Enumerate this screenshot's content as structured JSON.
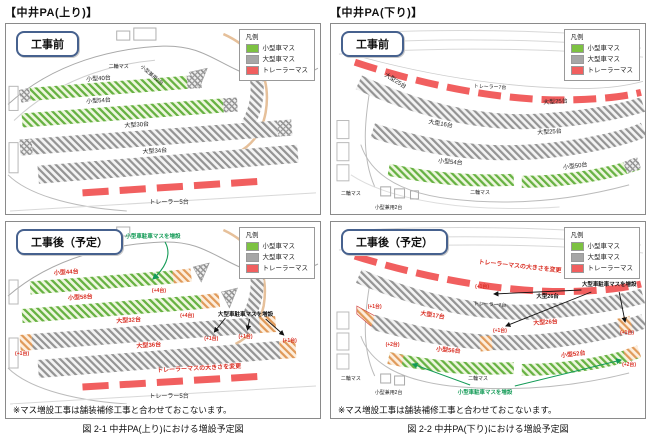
{
  "legend": {
    "title": "凡例",
    "small": "小型車マス",
    "large": "大型車マス",
    "trailer": "トレーラーマス"
  },
  "colors": {
    "small": "#7dc242",
    "large": "#a6a6a6",
    "trailer": "#f15f5f",
    "added_label": "#d93025",
    "annotation_green": "#149b57",
    "stage_frame": "#46618e"
  },
  "left": {
    "title": "【中井PA(上り)】",
    "caption": "図 2-1 中井PA(上り)における増設予定図",
    "note": "※マス増設工事は舗装補修工事と合わせておこないます。",
    "before": {
      "stage": "工事前",
      "labels": {
        "moto": "二輪マス",
        "combo": "小型兼用2台",
        "small1": "小型40台",
        "small2": "小型54台",
        "large1": "大型30台",
        "large2": "大型34台",
        "trailer": "トレーラー5台"
      }
    },
    "after": {
      "stage": "工事後（予定）",
      "labels": {
        "annot_small": "小型車駐車マスを増設",
        "annot_large": "大型車駐車マスを増設",
        "small1": "小型44台",
        "small1_add": "(+4台)",
        "small2": "小型58台",
        "small2_add": "(+4台)",
        "large1": "大型32台",
        "large2": "大型36台",
        "add1": "(+1台)",
        "add2": "(+1台)",
        "add3": "(+1台)",
        "add4": "(+1台)",
        "trailer_change": "トレーラーマスの大きさを変更",
        "trailer": "トレーラー5台"
      }
    }
  },
  "right": {
    "title": "【中井PA(下り)】",
    "caption": "図 2-2 中井PA(下り)における増設予定図",
    "note": "※マス増設工事は舗装補修工事と合わせておこないます。",
    "before": {
      "stage": "工事前",
      "labels": {
        "large_diag": "大型25台",
        "trailer": "トレーラー7台",
        "large_right": "大型25台",
        "large_mid_left": "大型16台",
        "large_mid_right": "大型25台",
        "small_left": "小型54台",
        "small_right": "小型50台",
        "moto": "二輪マス",
        "moto2": "二輪マス",
        "combo": "小型兼用2台"
      }
    },
    "after": {
      "stage": "工事後（予定）",
      "labels": {
        "trailer_change": "トレーラーマスの大きさを変更",
        "trailer": "トレーラー7台",
        "large_right": "大型26台",
        "large_mid_left": "大型17台",
        "large_mid_right": "大型26台",
        "add1": "(+1台)",
        "add2": "(+1台)",
        "add3": "(+1台)",
        "add4": "(+1台)",
        "small_left": "小型56台",
        "small_left_add": "(+2台)",
        "small_right": "小型52台",
        "small_right_add": "(+2台)",
        "annot_small": "小型車駐車マスを増設",
        "annot_large": "大型車駐車マスを増設",
        "moto": "二輪マス",
        "moto2": "二輪マス",
        "combo": "小型兼用2台"
      }
    }
  }
}
